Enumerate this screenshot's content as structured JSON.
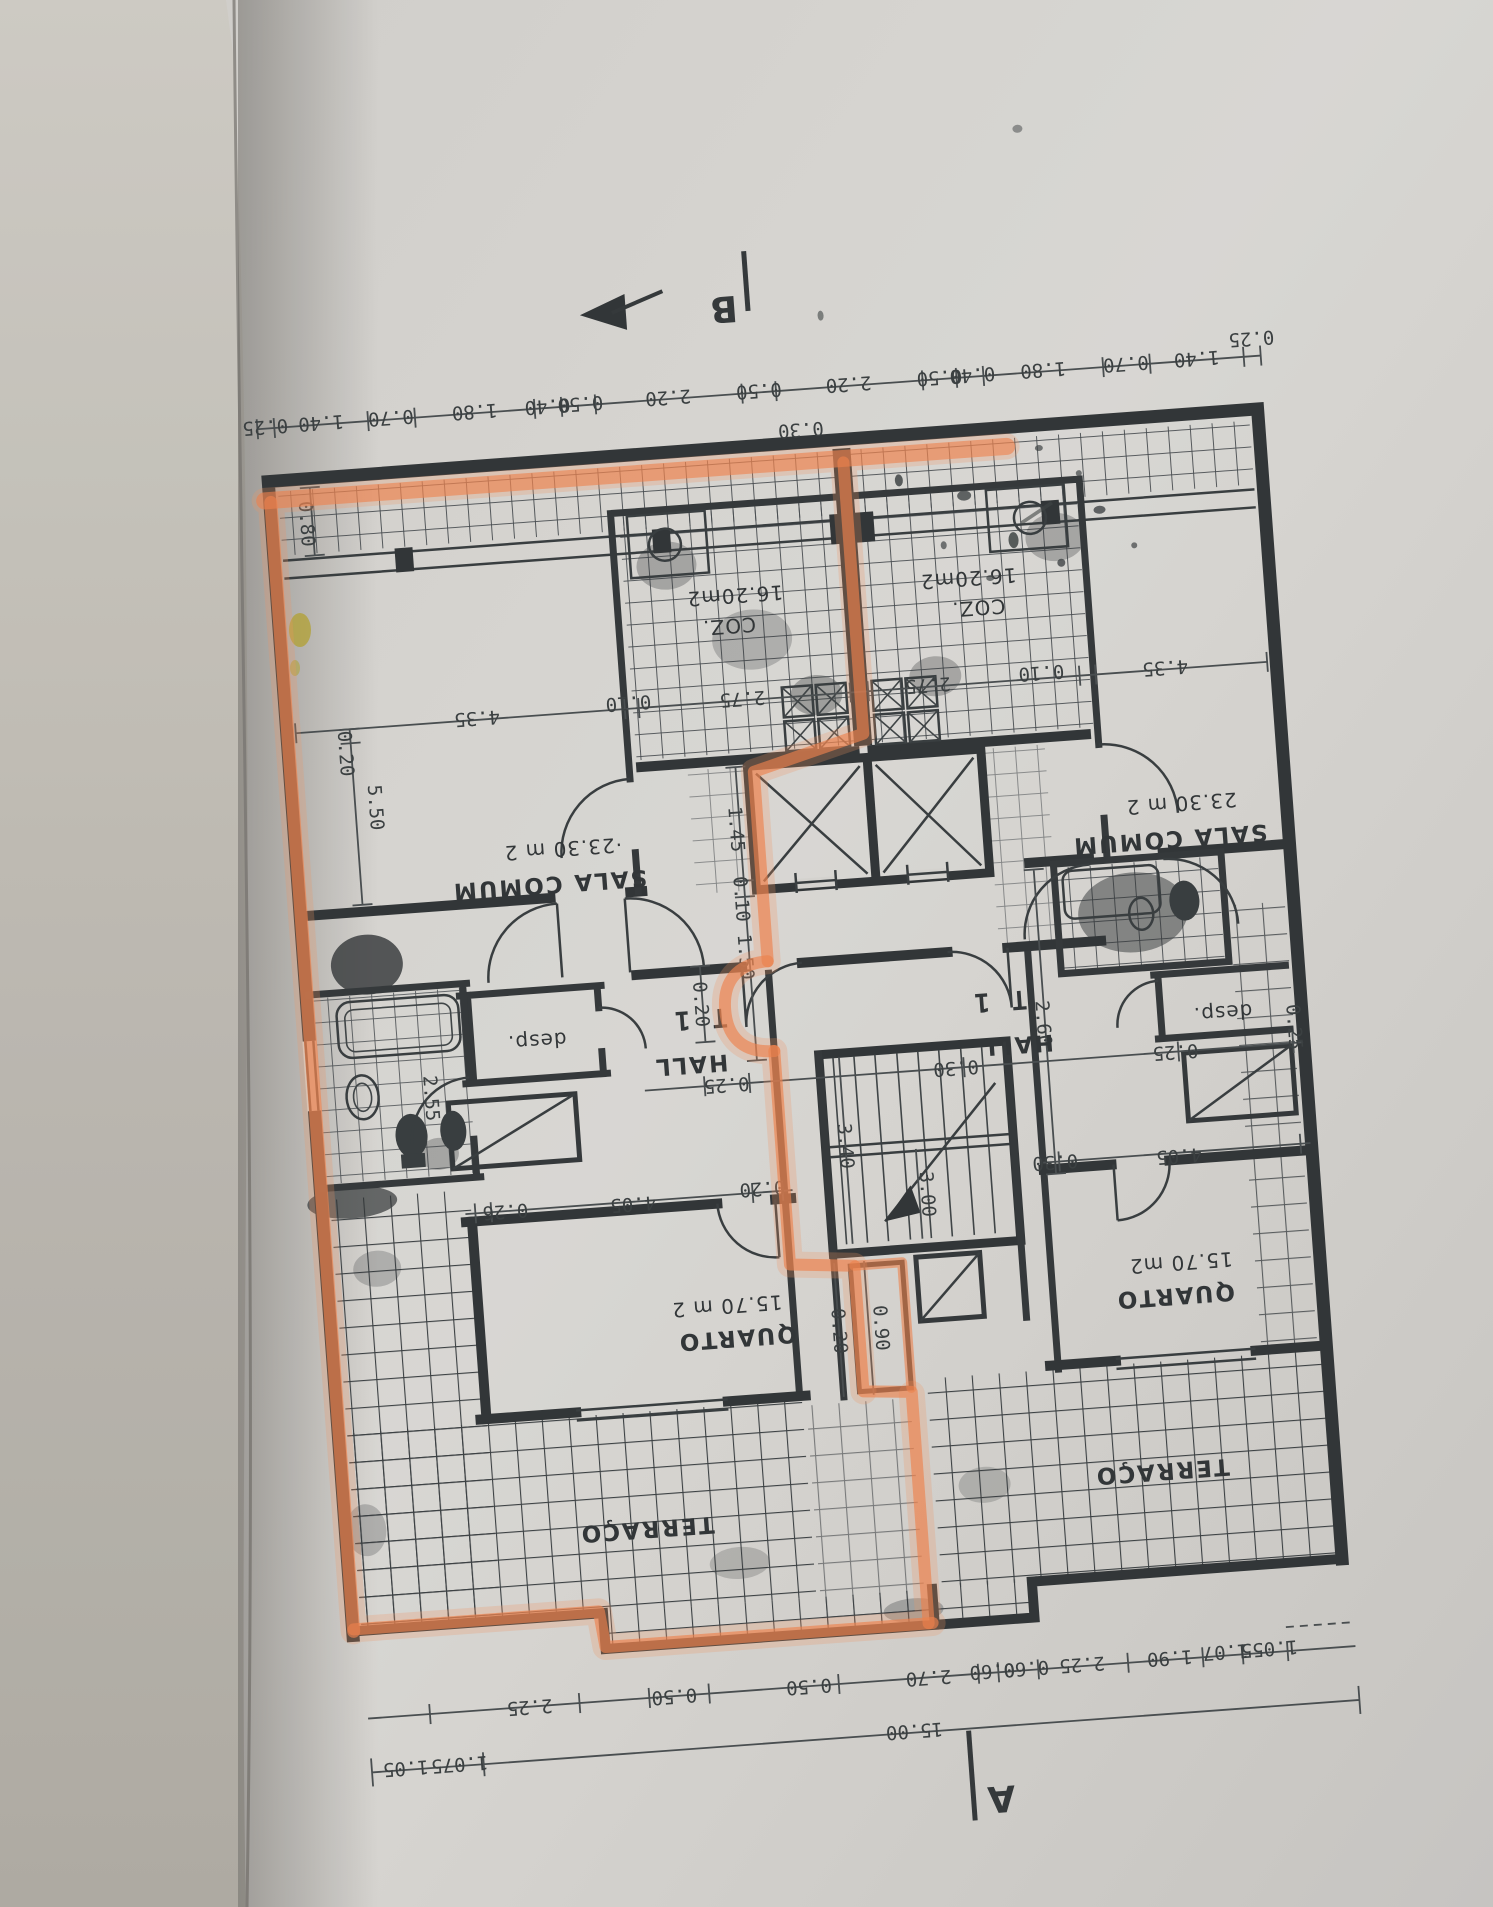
{
  "colors": {
    "highlighter_orange": "#f08048",
    "ink": "#2c3032",
    "paper": "#d6d4d0"
  },
  "plan": {
    "rooms": {
      "sala_left": {
        "area": "·23.30 m 2",
        "name": "SALA COMUM"
      },
      "sala_right": {
        "area": "23.30 m 2",
        "name": "SALA COMUM"
      },
      "coz_left": {
        "area": "16.20m2",
        "name": "COZ."
      },
      "coz_right": {
        "area": "16.20m2",
        "name": "COZ."
      },
      "quarto_left": {
        "area": "15.70 m 2",
        "name": "QUARTO"
      },
      "quarto_right": {
        "area": "15.70 m2",
        "name": "QUARTO"
      },
      "hall_left": {
        "name": "HALL",
        "type": "T 1"
      },
      "hall_right": {
        "name": "HALL",
        "type": "T 1"
      },
      "desp_left": {
        "name": "desp."
      },
      "desp_right": {
        "name": "desp."
      },
      "terraco_left": {
        "name": "TERRAÇO"
      },
      "terraco_right": {
        "name": "TERRAÇO"
      }
    },
    "markers": {
      "a": "A",
      "b": "B"
    },
    "dims": {
      "top": [
        "0.25",
        "1.40",
        "0.70",
        "1.80",
        "0.40",
        "0.50",
        "2.20",
        "0.50",
        "2.20",
        "0.50",
        "0.40",
        "1.80",
        "0.70",
        "1.40",
        "0.25"
      ],
      "duct": "0.30",
      "balcony_depth": "0.80",
      "wall_thickness": "0.20",
      "sala_height": "5.50",
      "interior_row": [
        "4.35",
        "0.10",
        "2.75",
        "2.75",
        "0.10",
        "4.35"
      ],
      "elevator_col": [
        "1.45",
        "0.10",
        "1.50"
      ],
      "hall_left_door": "0.20",
      "hall_right_height": "2.60",
      "mid_row": [
        "0.25",
        "0.30",
        "0.25",
        "0.25"
      ],
      "bath_width": "2.55",
      "quarto_left_row": [
        "0.26",
        "4.05",
        "0.20"
      ],
      "quarto_right_row": [
        "0.30",
        "4.05"
      ],
      "stairs": [
        "3.40",
        "3.00"
      ],
      "step_col": [
        "0.20",
        "0.90"
      ],
      "bottom_row": [
        "2.25",
        "0.50",
        "0.50",
        "2.70",
        "0.60",
        "0.60",
        "2.25",
        "1.90",
        "1.07",
        "1.055"
      ],
      "total": "15.00",
      "end_pair_left": [
        "1.05",
        "1.075"
      ]
    }
  }
}
